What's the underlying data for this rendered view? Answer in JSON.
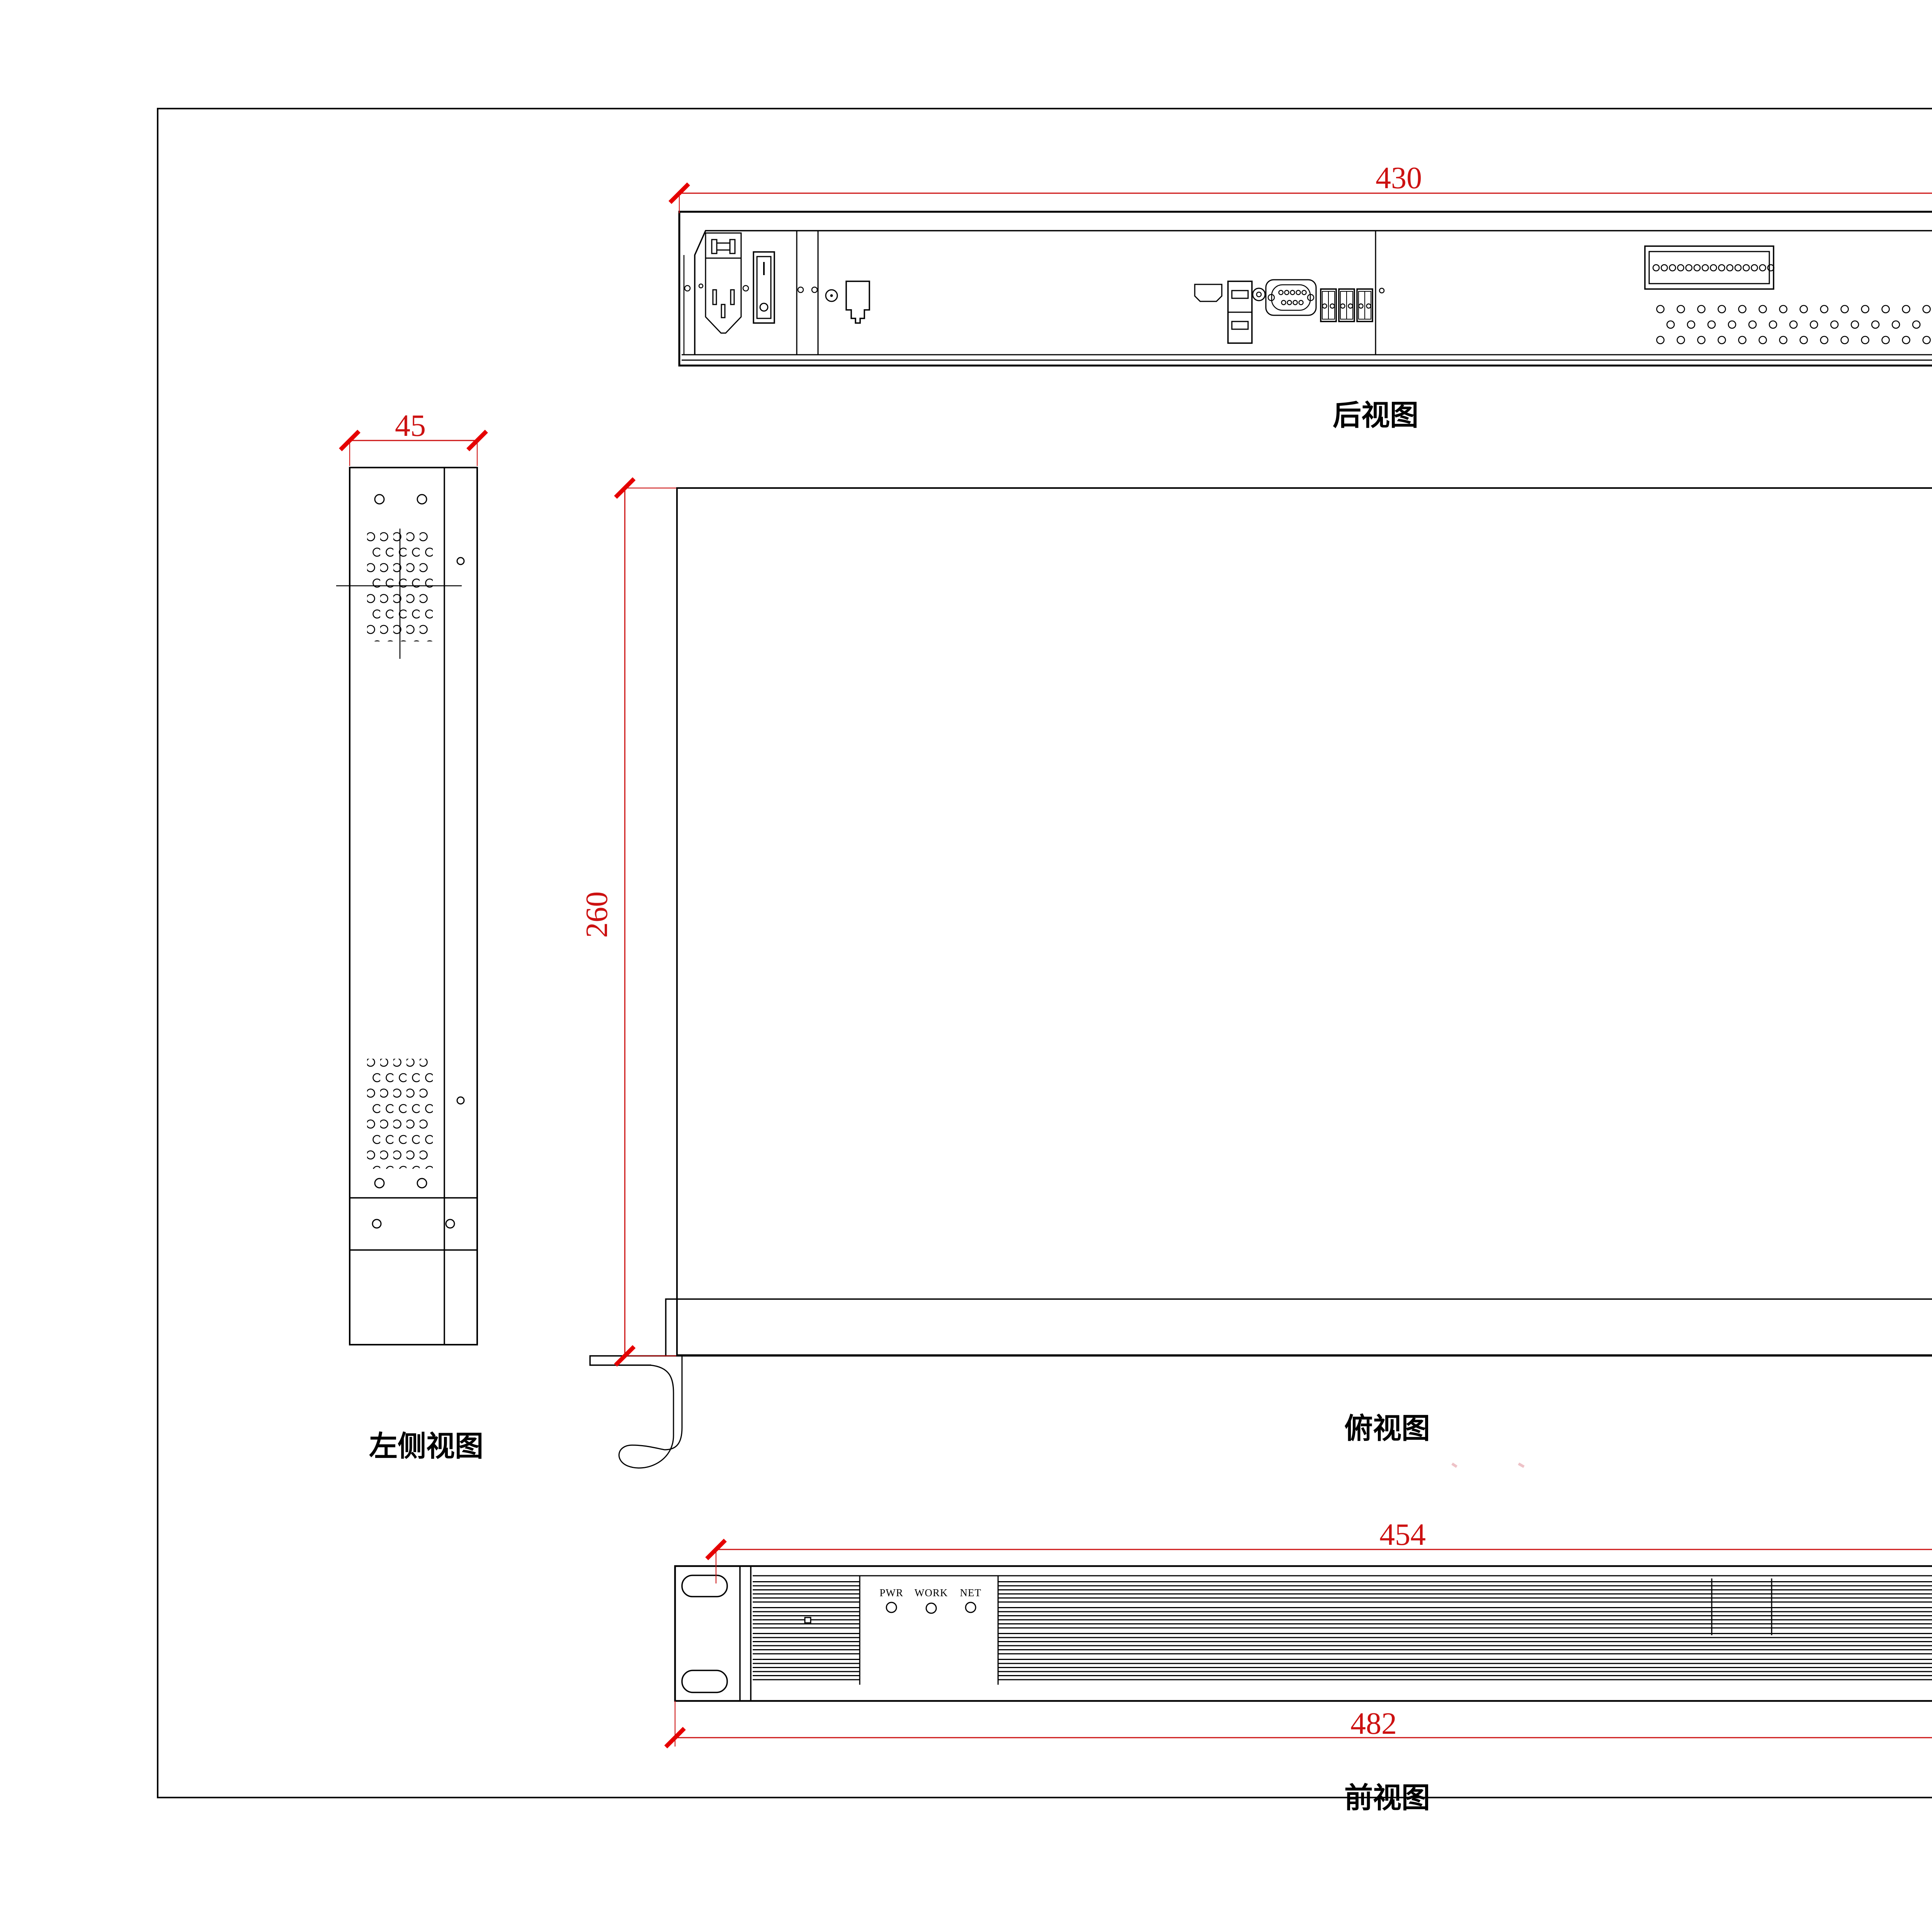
{
  "unit_label": "单位：mm",
  "views": {
    "rear": {
      "label": "后视图",
      "dim_width": "430"
    },
    "left_side": {
      "label": "左侧视图",
      "dim_width": "45"
    },
    "top": {
      "label": "俯视图",
      "dim_depth": "260"
    },
    "right_side": {
      "label": "右侧视图"
    },
    "front": {
      "label": "前视图",
      "dim_inner": "454",
      "dim_outer": "482",
      "led_labels": [
        "PWR",
        "WORK",
        "NET"
      ]
    }
  },
  "colors": {
    "dimension_red": "#cc1111",
    "tick_red": "#e60000",
    "line_black": "#000000",
    "background": "#ffffff"
  }
}
